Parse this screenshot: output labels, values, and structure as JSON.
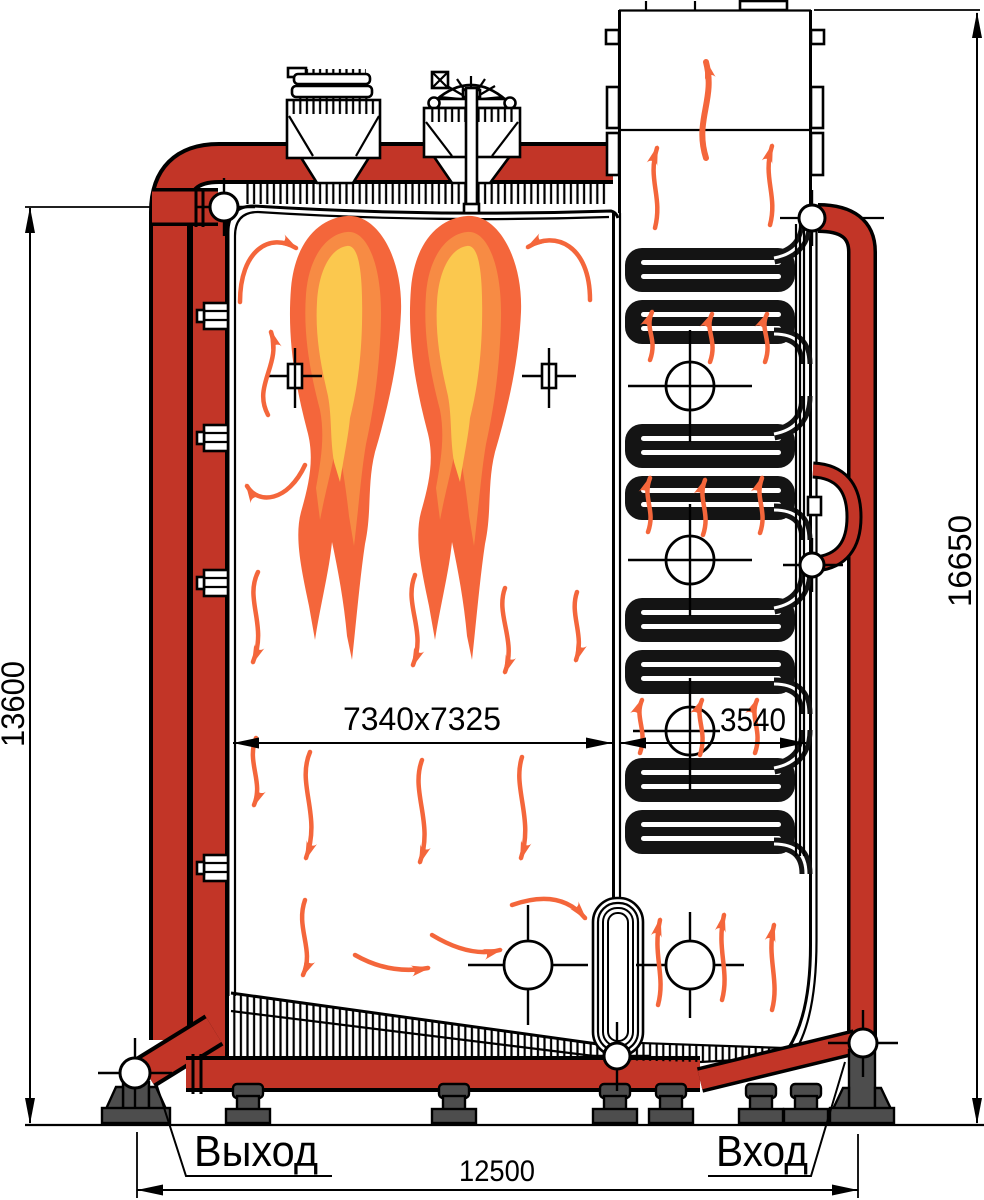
{
  "drawing": {
    "labels": {
      "outlet": "Выход",
      "inlet": "Вход"
    },
    "dimensions": {
      "overall_height_left": "13600",
      "overall_height_right": "16650",
      "furnace_size": "7340x7325",
      "convective_pass_width": "3540",
      "overall_length": "12500"
    },
    "colors": {
      "pipe_red": "#c23527",
      "flame_outer": "#f4663b",
      "flame_mid": "#f78b44",
      "flame_core": "#fbc84e",
      "arrow_orange": "#f4663b",
      "steel_dark": "#4d4d4d",
      "coil_dark": "#141414",
      "line_black": "#000000"
    }
  }
}
